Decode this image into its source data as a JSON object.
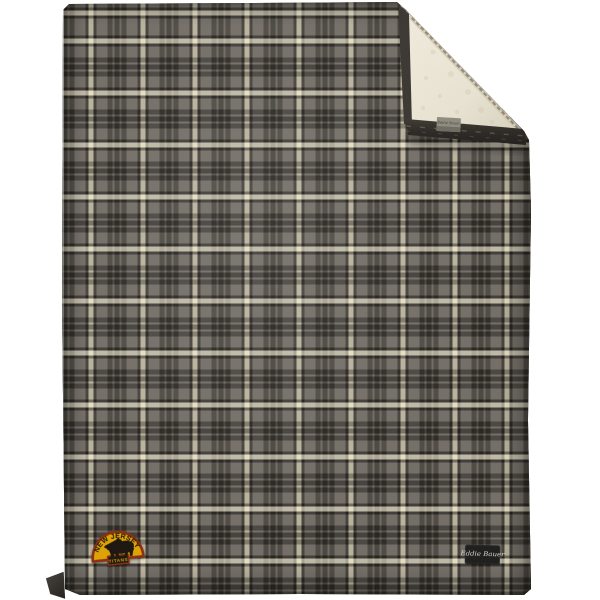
{
  "background": {
    "color": "#FFFFFF"
  },
  "blanket": {
    "plaid": {
      "base_gray": "#746F67",
      "dark_band": "#3A3631",
      "dark_line": "#33302C",
      "cream_stripe": "#D9D1B6",
      "repeat_px": 52
    },
    "sherpa_lining": {
      "color_light": "#EFEADB",
      "color_shade": "#DCD5C1"
    },
    "fold_tag": {
      "text": "Eddie Bauer",
      "bg": "#908D80"
    },
    "brand_label": {
      "text": "Eddie Bauer",
      "bg": "#1D1D1B",
      "text_color": "#D9D7CF"
    },
    "patch": {
      "arc_text": "NEW JERSEY",
      "banner_text": "TITANS",
      "icon": "bear-icon",
      "gold": "#DFA303",
      "border": "#8B2E10",
      "ink": "#1B150F"
    }
  }
}
